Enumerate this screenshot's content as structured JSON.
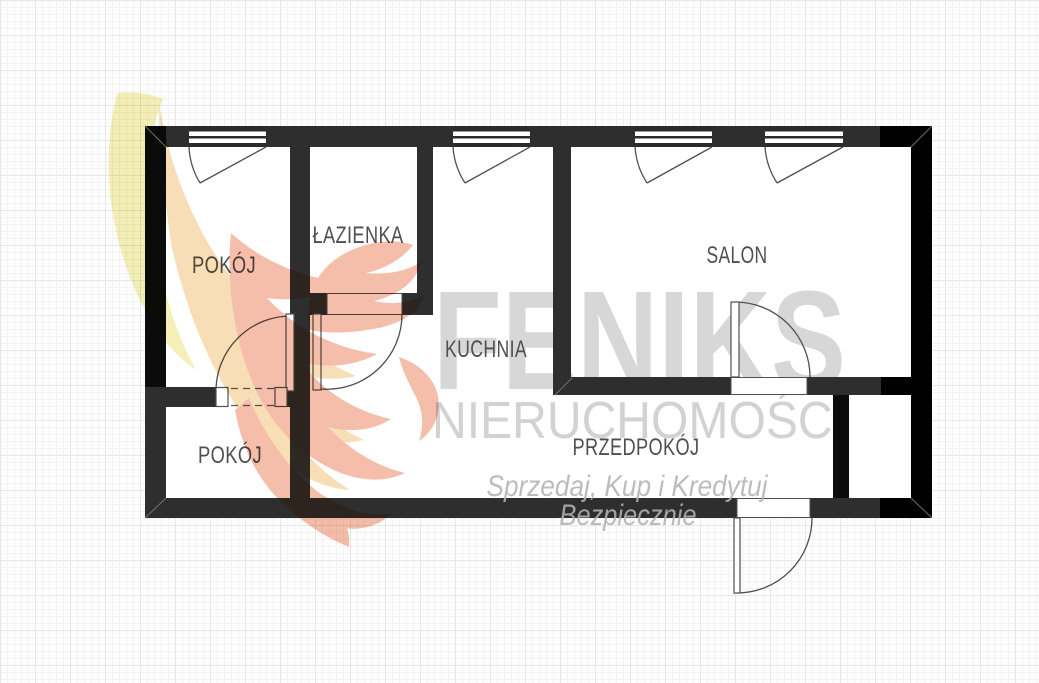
{
  "background": {
    "base_color": "#fdfdfd",
    "grid_minor_color": "#f3f3f3",
    "grid_major_color": "#e7e7e7"
  },
  "watermark": {
    "brand": "FENIKS",
    "subtitle": "NIERUCHOMOŚCI",
    "slogan_line1": "Sprzedaj, Kup i Kredytuj",
    "slogan_line2": "Bezpiecznie",
    "brand_color": "#d7d7d7",
    "subtitle_color": "#d2d2d2",
    "slogan_color": "#b3b3b3",
    "feather_colors": {
      "yellow": "#f3efb2",
      "cream": "#f8dcb0",
      "salmon": "#f5b9a4"
    }
  },
  "floorplan": {
    "wall_color": "#2e2e2e",
    "wall_shadow_color": "#000000",
    "line_color": "#4f4f4f",
    "label_color": "#4f4f4f",
    "floor_color": "#ffffff",
    "rooms": [
      {
        "id": "pokoj-top",
        "label": "POKÓJ"
      },
      {
        "id": "lazienka",
        "label": "ŁAZIENKA"
      },
      {
        "id": "kuchnia",
        "label": "KUCHNIA"
      },
      {
        "id": "salon",
        "label": "SALON"
      },
      {
        "id": "pokoj-bottom",
        "label": "POKÓJ"
      },
      {
        "id": "przedpokoj",
        "label": "PRZEDPOKÓJ"
      }
    ],
    "symbols": [
      {
        "name": "window-symbol",
        "count": 4
      },
      {
        "name": "door-swing-symbol",
        "count": 4
      },
      {
        "name": "dashed-opening-symbol",
        "count": 1
      }
    ]
  }
}
